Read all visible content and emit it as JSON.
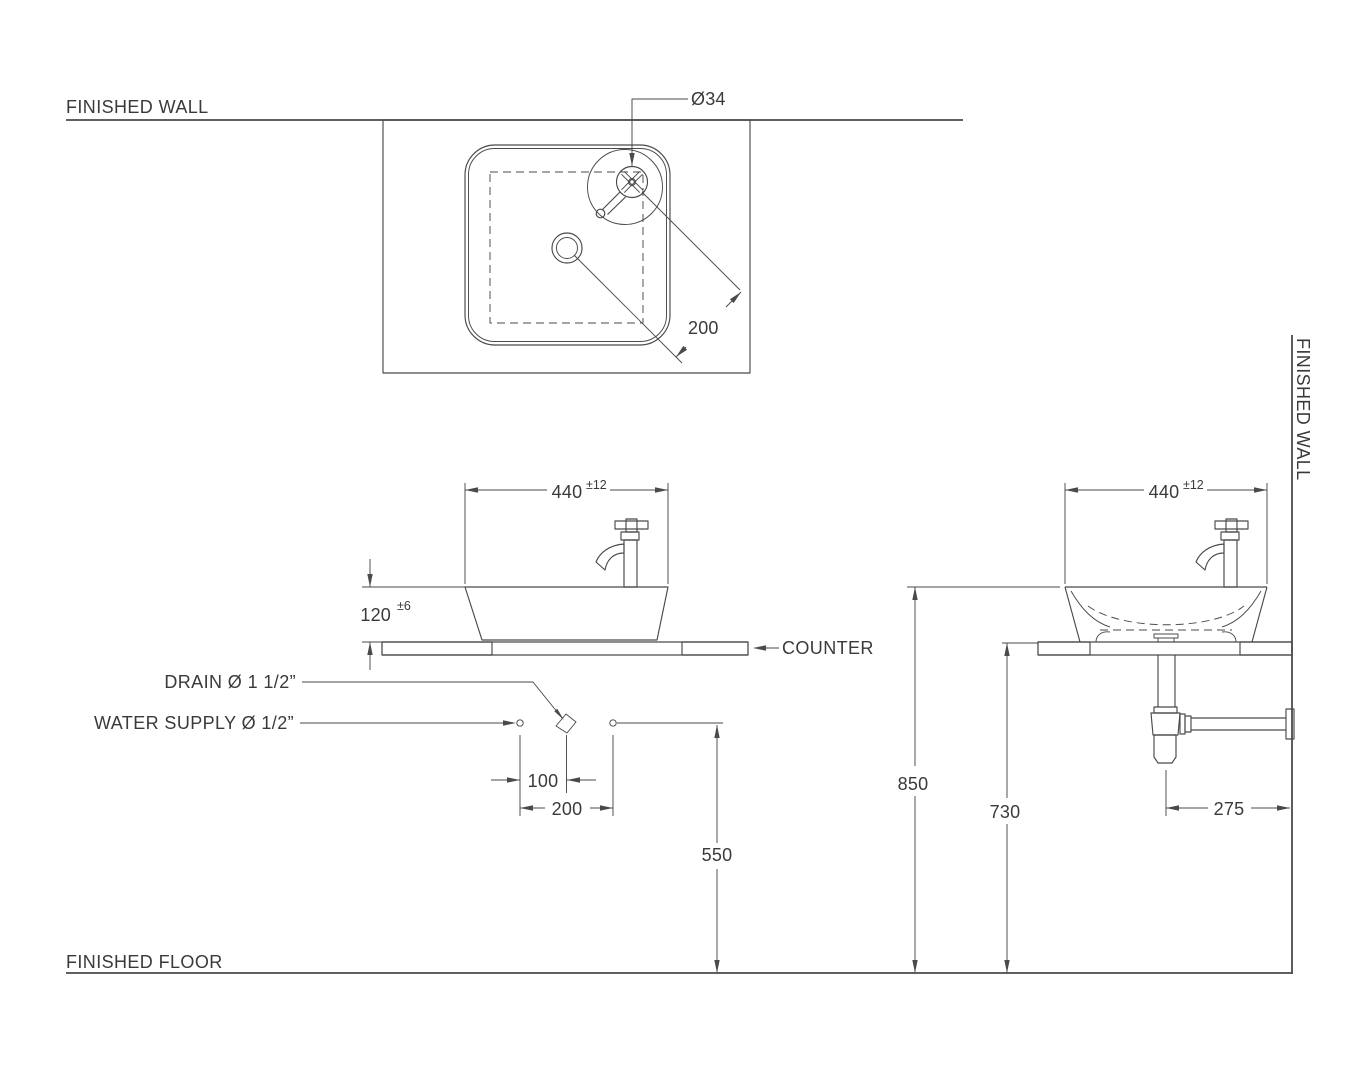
{
  "colors": {
    "background": "#ffffff",
    "line": "#4a4a4a",
    "text": "#3a3a3a"
  },
  "labels": {
    "finished_wall_top": "FINISHED WALL",
    "finished_wall_right": "FINISHED WALL",
    "finished_floor": "FINISHED FLOOR",
    "counter": "COUNTER",
    "drain": "DRAIN Ø 1 1/2”",
    "water_supply": "WATER SUPPLY Ø 1/2”"
  },
  "top_view": {
    "faucet_hole_diameter": "Ø34",
    "drain_to_faucet_distance": "200"
  },
  "front_view": {
    "basin_width": "440",
    "basin_width_tolerance": "±12",
    "basin_height": "120",
    "basin_height_tolerance": "±6",
    "drain_to_supply_spacing": "100",
    "supply_spacing": "200",
    "supply_height_from_floor": "550"
  },
  "side_view": {
    "basin_depth": "440",
    "basin_depth_tolerance": "±12",
    "rim_height_from_floor": "850",
    "counter_height_from_floor": "730",
    "trap_offset_from_wall": "275"
  }
}
